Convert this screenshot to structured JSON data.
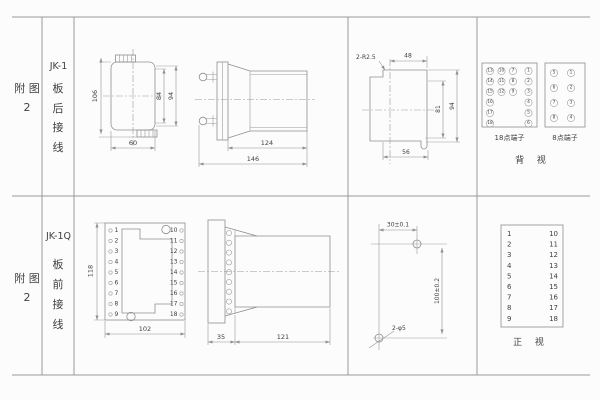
{
  "colors": {
    "line": "#8f8f8f",
    "text": "#3f3f3f",
    "background": "#fcfcfc"
  },
  "rows": [
    {
      "figure_label": "附 图 2",
      "model": "JK-1",
      "wiring": "板 后 接 线"
    },
    {
      "figure_label": "附 图 2",
      "model": "JK-1Q",
      "wiring": "板 前 接 线"
    }
  ],
  "rear": {
    "front_view": {
      "height": "106",
      "inner_height": "84",
      "outer_height": "94",
      "width": "60"
    },
    "side_view": {
      "body_depth": "124",
      "total_depth": "146"
    },
    "cutout": {
      "corner_note": "2-R2.5",
      "top_width": "48",
      "inner_height": "81",
      "height": "94",
      "bottom_width": "56"
    },
    "terminals": {
      "p18_label": "18点端子",
      "p8_label": "8点端子",
      "view_label": "背 视",
      "p18_col1": [
        "13",
        "14",
        "15",
        "16",
        "17",
        "18"
      ],
      "p18_col2": [
        "10",
        "11",
        "12"
      ],
      "p18_col3": [
        "7",
        "8",
        "9"
      ],
      "p18_col4": [
        "1",
        "2",
        "3",
        "4",
        "5",
        "6"
      ],
      "p8_left": [
        "5",
        "6",
        "7",
        "8"
      ],
      "p8_right": [
        "1",
        "2",
        "3",
        "4"
      ]
    }
  },
  "front": {
    "plate": {
      "height": "118",
      "width": "102",
      "left": [
        "1",
        "2",
        "3",
        "4",
        "5",
        "6",
        "7",
        "8",
        "9"
      ],
      "right": [
        "10",
        "11",
        "12",
        "13",
        "14",
        "15",
        "16",
        "17",
        "18"
      ]
    },
    "side_view": {
      "plate_depth": "35",
      "body_depth": "121"
    },
    "drill": {
      "h_dim": "30±0.1",
      "v_dim": "100±0.2",
      "hole_note": "2-φ5"
    },
    "table": {
      "left": [
        "1",
        "2",
        "3",
        "4",
        "5",
        "6",
        "7",
        "8",
        "9"
      ],
      "right": [
        "10",
        "11",
        "12",
        "13",
        "14",
        "15",
        "16",
        "17",
        "18"
      ],
      "view_label": "正 视"
    }
  }
}
